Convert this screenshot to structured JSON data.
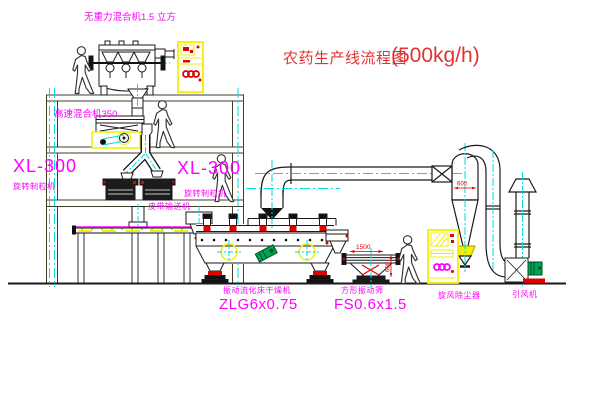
{
  "title": {
    "name": "农药生产线流程图",
    "capacity": "(500kg/h)"
  },
  "equipment_labels": {
    "gravity_mixer": "无重力混合机1.5 立方",
    "high_speed_mixer": "高速混合机350",
    "granulator_left": {
      "model": "XL-300",
      "name": "旋转制粒机"
    },
    "granulator_right": {
      "model": "XL-300",
      "name": "旋转制粒机"
    },
    "belt_conveyor": "皮带输送机",
    "fluid_bed_dryer": {
      "name": "振动流化床干燥机",
      "model": "ZLG6x0.75"
    },
    "square_sieve": {
      "name": "方形振动筛",
      "model": "FS0.6x1.5"
    },
    "cyclone": "旋风除尘器",
    "induced_draft_fan": "引风机"
  },
  "dimensions": {
    "sieve_length": "1500",
    "cyclone_diameter": "600",
    "sieve_height": "600"
  },
  "colors": {
    "label_magenta": "#ff00ff",
    "title_red": "#e23333",
    "annotation_red": "#e00000",
    "cabinet_yellow": "#f0f000",
    "centerline_cyan": "#00dcdc",
    "motor_green": "#00a550",
    "line_black": "#1a1a1a"
  }
}
